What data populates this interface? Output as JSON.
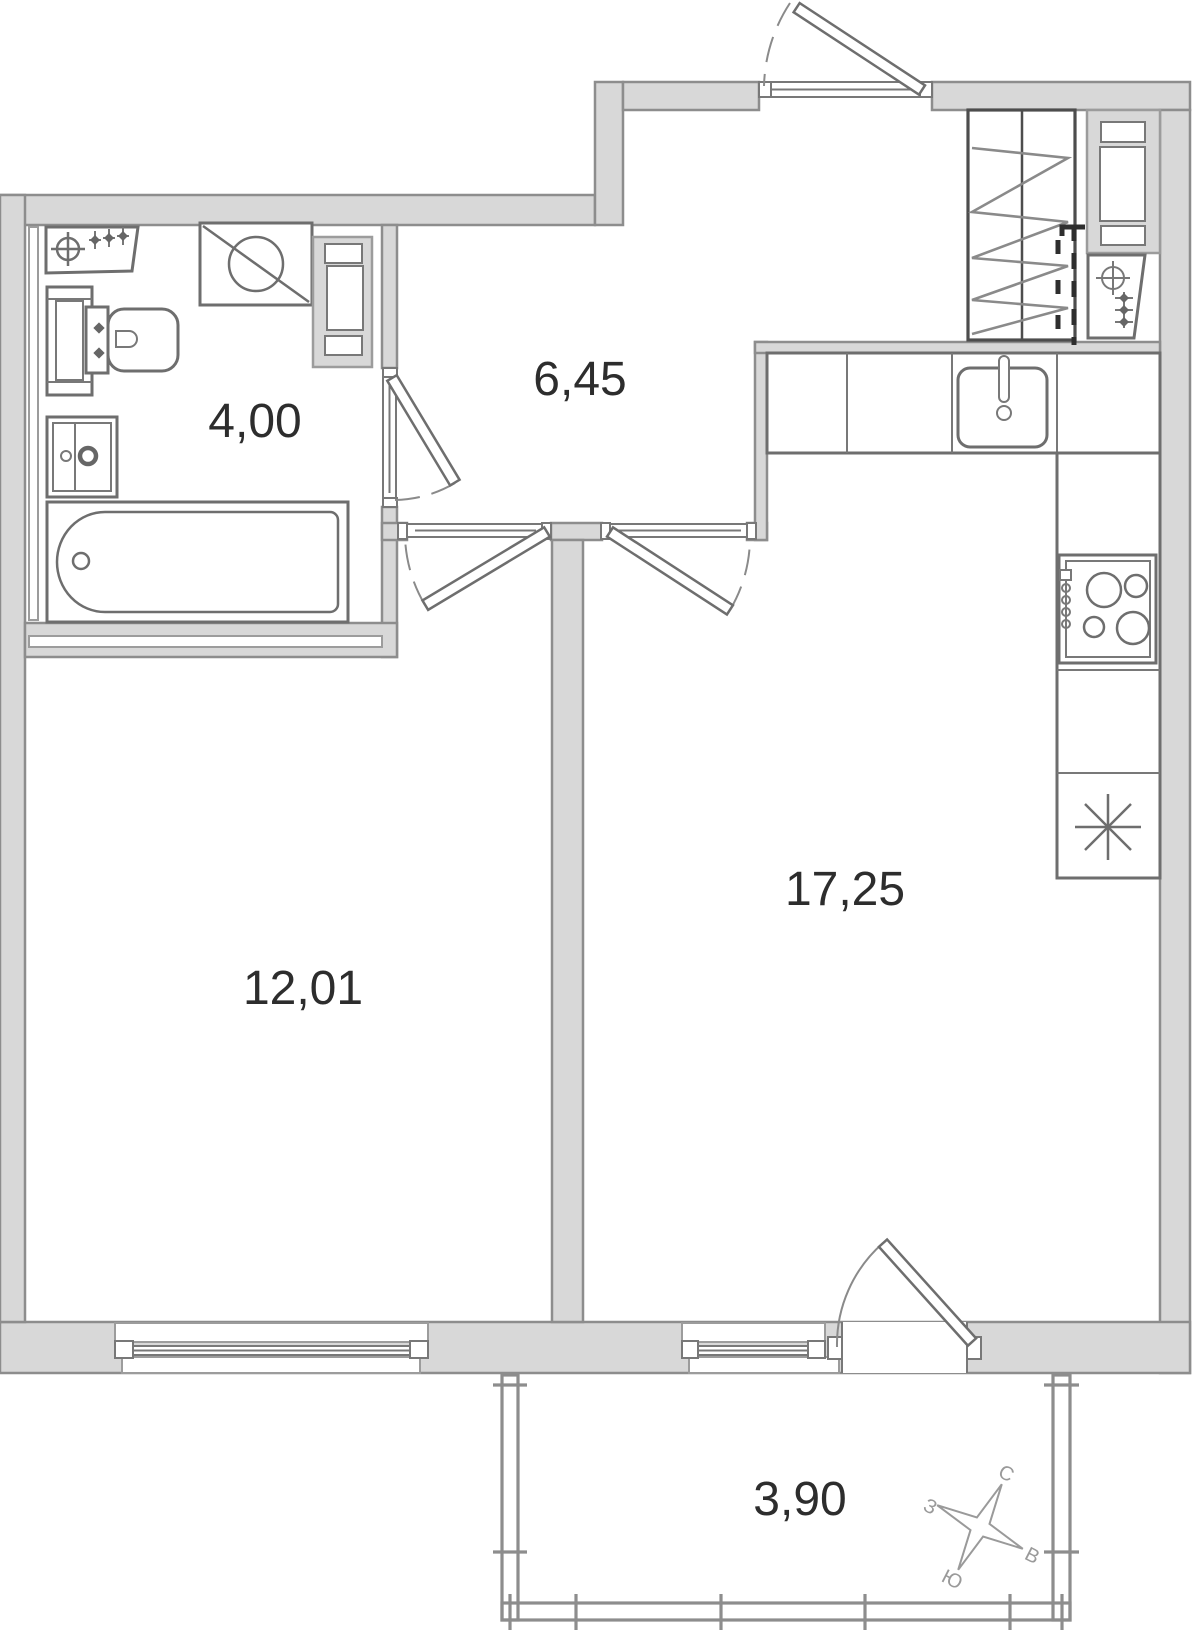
{
  "plan": {
    "type": "apartment-floor-plan",
    "rooms": [
      {
        "id": "bathroom",
        "area": "4,00"
      },
      {
        "id": "hallway",
        "area": "6,45"
      },
      {
        "id": "bedroom",
        "area": "12,01"
      },
      {
        "id": "kitchen-living",
        "area": "17,25"
      },
      {
        "id": "balcony",
        "area": "3,90"
      }
    ],
    "compass": {
      "north": "С",
      "east": "В",
      "south": "Ю",
      "west": "З"
    },
    "colors": {
      "wall_fill": "#d8d8d8",
      "wall_stroke": "#8d8d8d",
      "fixture_stroke": "#6e6e6e",
      "label_color": "#2d2d2d",
      "compass_color": "#9a9a9a",
      "dash_color": "#2e2e2e"
    }
  }
}
